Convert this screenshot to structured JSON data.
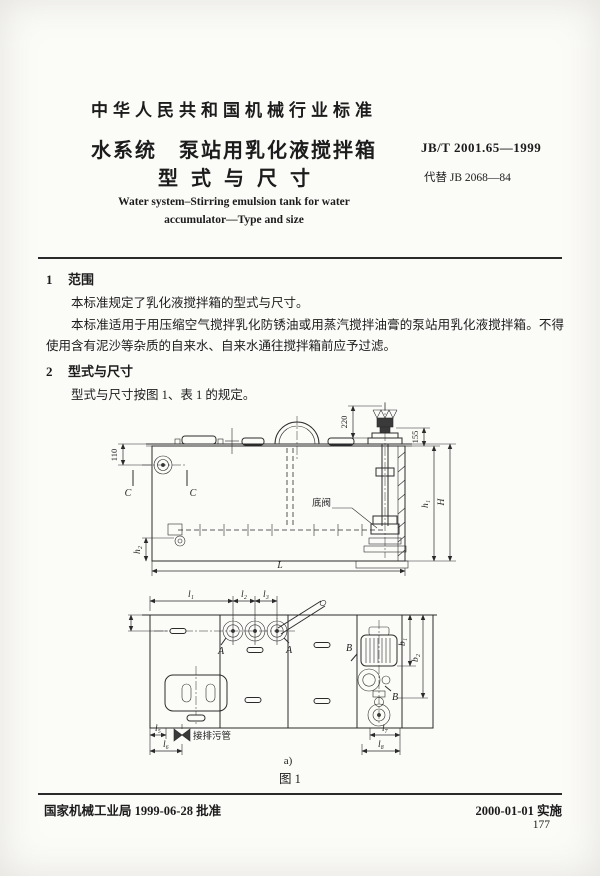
{
  "header": {
    "standard_class": "中华人民共和国机械行业标准",
    "title_cn_line1": "水系统　泵站用乳化液搅拌箱",
    "title_cn_line2": "型式与尺寸",
    "standard_number": "JB/T 2001.65—1999",
    "replaces": "代替 JB 2068—84",
    "title_en_line1": "Water system–Stirring emulsion tank for water",
    "title_en_line2": "accumulator—Type and size"
  },
  "body": {
    "section1_number": "1",
    "section1_heading": "范围",
    "section1_para1": "本标准规定了乳化液搅拌箱的型式与尺寸。",
    "section1_para2": "本标准适用于用压缩空气搅拌乳化防锈油或用蒸汽搅拌油膏的泵站用乳化液搅拌箱。不得使用含有泥沙等杂质的自来水、自来水通往搅拌箱前应予过滤。",
    "section2_number": "2",
    "section2_heading": "型式与尺寸",
    "section2_para1": "型式与尺寸按图 1、表 1 的规定。"
  },
  "figure": {
    "caption": "图 1",
    "sub_label": "a)",
    "labels": {
      "dim_110": "110",
      "dim_220": "220",
      "dim_155": "155",
      "dim_h1": "h₁",
      "dim_H": "H",
      "dim_h2": "h₂",
      "dim_L": "L",
      "section_c": "C",
      "bottom_valve": "底阀",
      "dim_l1": "l₁",
      "dim_l2": "l₂",
      "dim_l3": "l₃",
      "section_a": "A",
      "section_b": "B",
      "dim_b1": "b₁",
      "dim_b2": "b₂",
      "dim_l5": "l₅",
      "dim_l6": "l₆",
      "dim_l7": "l₇",
      "dim_l8": "l₈",
      "drain_pipe": "接排污管"
    }
  },
  "footer": {
    "approval": "国家机械工业局 1999-06-28 批准",
    "implementation": "2000-01-01 实施",
    "page_number": "177"
  }
}
